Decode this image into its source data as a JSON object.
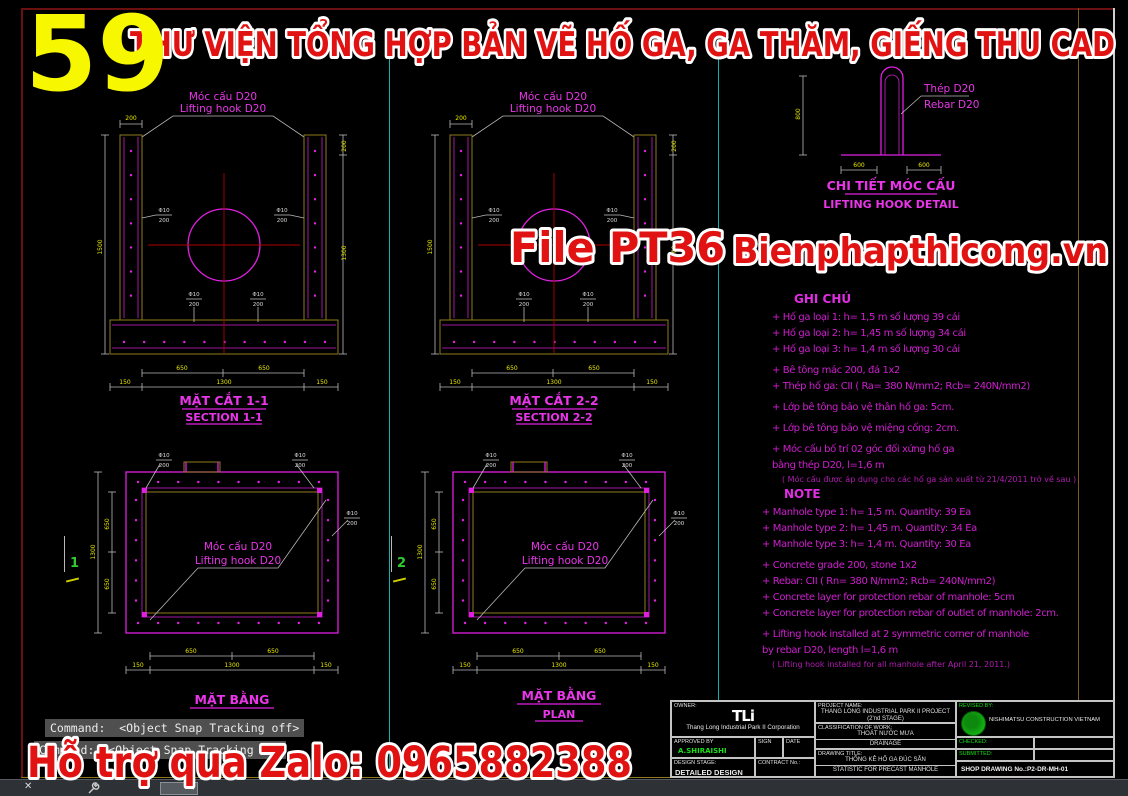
{
  "banner": {
    "number": "59",
    "title": "THƯ VIỆN TỔNG HỢP BẢN VẼ HỐ GA, GA THĂM, GIẾNG THU CAD"
  },
  "watermarks": {
    "file": "File PT36",
    "site": "Bienphapthicong.vn",
    "zalo": "Hỗ trợ qua Zalo: 0965882388"
  },
  "sections": {
    "hook_label_vi": "Móc cấu D20",
    "hook_label_en": "Lifting hook D20",
    "s1_title_vi": "MẶT CẮT 1-1",
    "s1_title_en": "SECTION 1-1",
    "s2_title_vi": "MẶT CẮT 2-2",
    "s2_title_en": "SECTION 2-2"
  },
  "hook_detail": {
    "label_vi": "Thép D20",
    "label_en": "Rebar D20",
    "title_vi": "CHI TIẾT MÓC CẤU",
    "title_en": "LIFTING HOOK DETAIL"
  },
  "plans": {
    "p1_title_vi": "MẶT BẰNG",
    "p2_title_vi": "MẶT BẰNG",
    "p2_title_en": "PLAN",
    "marker1": "1",
    "marker2": "2"
  },
  "dims": {
    "d150": "150",
    "d200": "200",
    "d600": "600",
    "d650": "650",
    "d800": "800",
    "d1300": "1300",
    "d1500": "1500",
    "rebar_dia": "Φ10",
    "rebar_sp": "200"
  },
  "notes_vi": {
    "title": "GHI CHÚ",
    "lines": [
      "+ Hố ga loại 1: h= 1,5 m số lượng 39 cái",
      "+ Hố ga loại 2: h= 1,45 m số lượng 34 cái",
      "+ Hố ga loại 3: h= 1,4 m số lượng 30 cái",
      "+ Bê tông mác 200, đá 1x2",
      "+ Thép hố ga: CII ( Ra= 380 N/mm2; Rcb= 240N/mm2)",
      "+ Lớp bê tông bảo vệ thân hố ga: 5cm.",
      "+ Lớp bê tông bảo vệ miệng cống: 2cm.",
      "+ Móc cấu bố trí 02 góc đối xứng hố ga",
      "bằng thép D20, l=1,6 m"
    ],
    "footnote": "( Móc cấu được áp dụng cho các hố ga sản xuất từ 21/4/2011 trở về sau )"
  },
  "notes_en": {
    "title": "NOTE",
    "lines": [
      "+ Manhole type 1: h= 1,5 m. Quantity: 39 Ea",
      "+ Manhole type 2: h= 1,45 m. Quantity: 34 Ea",
      "+ Manhole type 3: h= 1,4 m. Quantity: 30 Ea",
      "+ Concrete grade 200, stone 1x2",
      "+ Rebar: CII ( Rn= 380 N/mm2; Rcb= 240N/mm2)",
      "+ Concrete layer for protection rebar of manhole: 5cm",
      "+ Concrete layer for protection rebar of outlet of manhole: 2cm.",
      "+ Lifting hook installed at 2 symmetric corner of manhole",
      "by rebar D20, length l=1,6 m"
    ],
    "footnote": "( Lifting hook installed for all manhole after April 21, 2011.)"
  },
  "title_block": {
    "owner_label": "OWNER:",
    "logo": "TLi",
    "owner_name": "Thang Long Industrial Park II Corporation",
    "approved_label": "APPROVED BY",
    "sign_label": "SIGN",
    "date_label": "DATE",
    "approved_name": "A.SHIRAISHI",
    "design_stage_label": "DESIGN STAGE:",
    "design_stage_value": "DETAILED DESIGN",
    "contract_label": "CONTRACT No.:",
    "project_label": "PROJECT NAME:",
    "project_line1": "THANG LONG INDUSTRIAL PARK II PROJECT",
    "project_line2": "(2'nd STAGE)",
    "classification_label": "CLASSIFICATION OF WORK:",
    "classification_vi": "THOÁT NƯỚC MƯA",
    "classification_en": "DRAINAGE",
    "drawing_title_label": "DRAWING TITLE:",
    "drawing_title_vi": "THỐNG KÊ HỐ GA ĐÚC SẴN",
    "drawing_title_en": "STATISTIC FOR PRECAST MANHOLE",
    "revised_label": "REVISED BY:",
    "company": "NISHIMATSU CONSTRUCTION VIETNAM",
    "checked_label": "CHECKED:",
    "submitted_label": "SUBMITTED:",
    "shop_drawing": "SHOP DRAWING No.:P2-DR-MH-01"
  },
  "command_line": {
    "line1": "Command:  <Object Snap Tracking off>",
    "line2": "Command:  <Object Snap Tracking on>"
  },
  "status_bar": {
    "close_glyph": "✕",
    "dropdown_caret": "▾"
  }
}
